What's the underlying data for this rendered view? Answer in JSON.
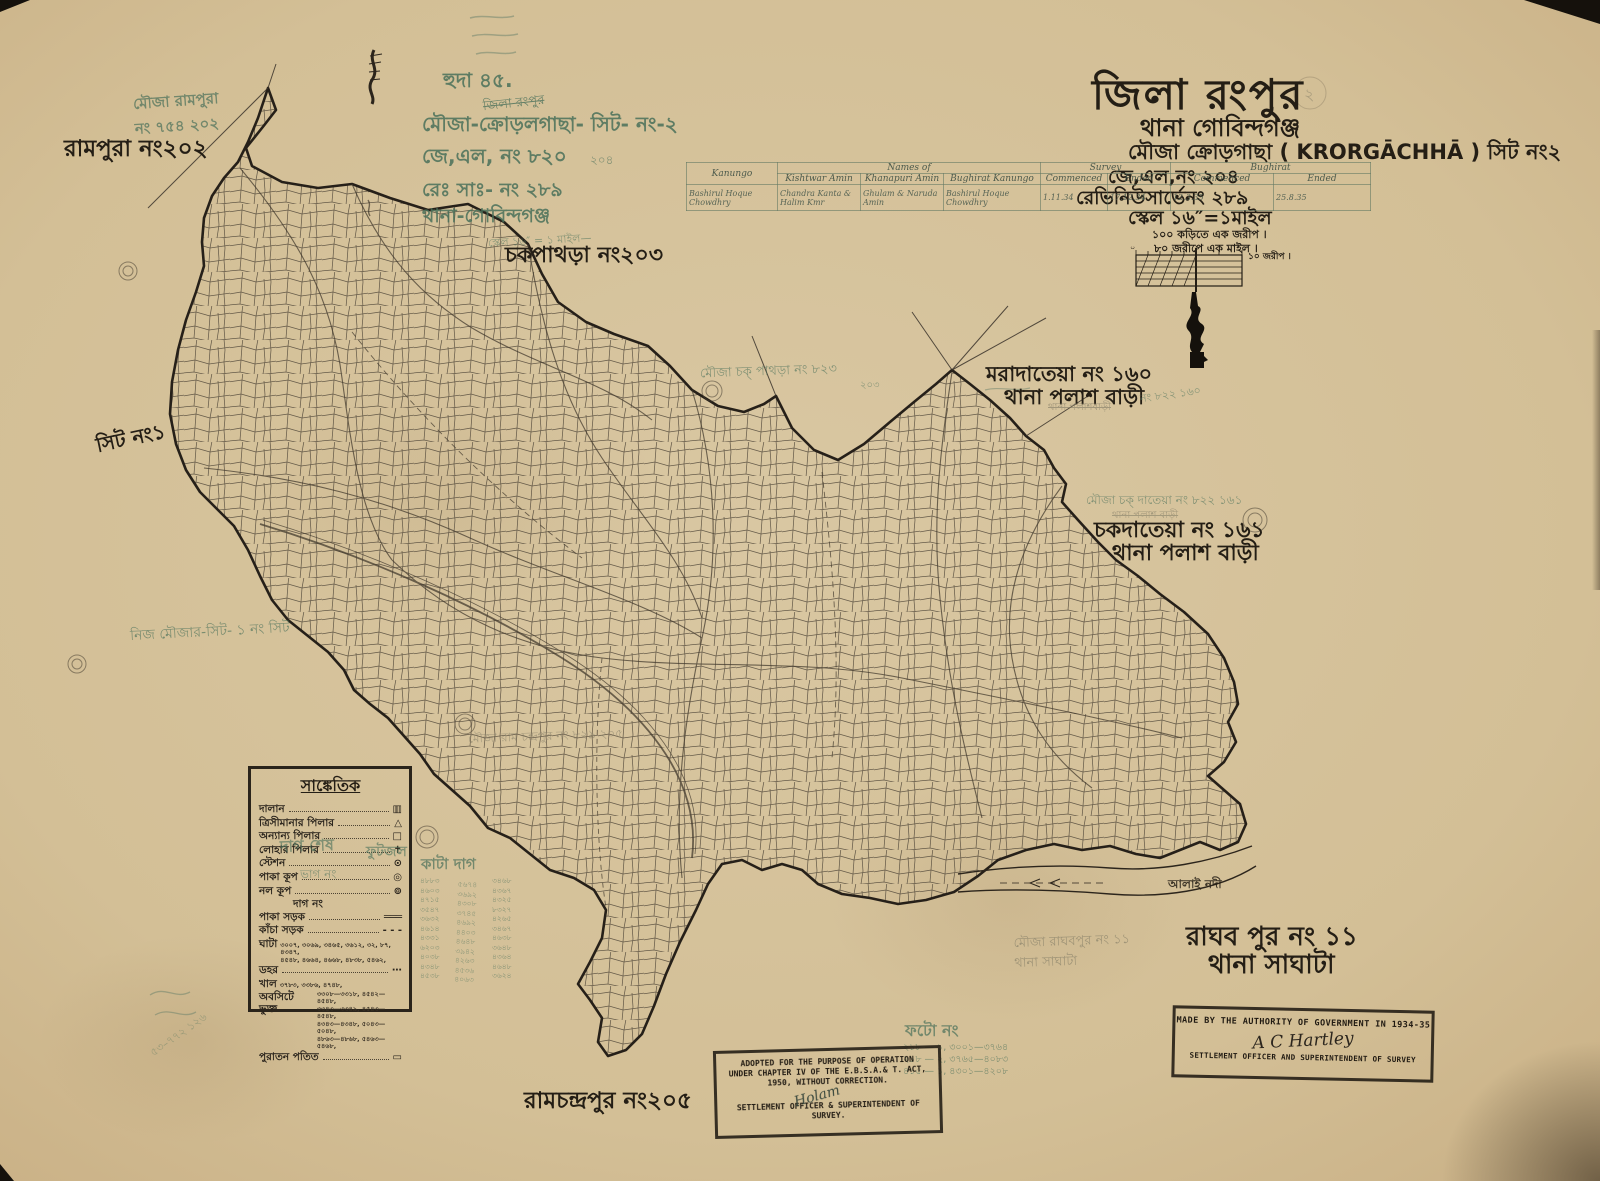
{
  "colors": {
    "paper": "#d3bf96",
    "ink": "#241e15",
    "green_ink": "#49705a",
    "pencil": "#7d7863",
    "table_line": "#6f8577"
  },
  "title_block": {
    "district": "জিলা রংপুর",
    "thana": "থানা গোবিন্দগঞ্জ",
    "mouza": "মৌজা ক্রোড়গাছা ( KRORGĀCHHĀ ) সিট নং২",
    "jl_no": "জে,এল,নং ২০৪",
    "revenue_survey_no": "রেভিনিউসার্ভেনং ২৮৯",
    "scale": "স্কেল ১৬″=১মাইল",
    "scale_note_1": "১০০ কড়িতে এক জরীপ ।",
    "scale_note_2": "৮০ জরীপে এক মাইল ।",
    "scale_bar_label": "১০ জরীপ ।",
    "scale_bar_zero": "০",
    "page_mark": "২"
  },
  "survey_table": {
    "col_kanungo": "Kanungo",
    "col_names_of": "Names of",
    "col_survey": "Survey",
    "col_right_block": "Bughirat",
    "sub_columns": [
      "Kishtwar Amin",
      "Khanapuri Amin",
      "Bughirat Kanungo",
      "Commenced",
      "Ended",
      "Commenced",
      "Ended"
    ],
    "entries": [
      "Bashirul Hoque Chowdhry",
      "Chandra Kanta & Halim Kmr",
      "Ghulam & Naruda Amin",
      "Bashirul Hoque Chowdhry",
      "1.11.34",
      "17.12.34",
      "12.3.35",
      "25.8.35"
    ]
  },
  "legend": {
    "title": "সাঙ্কেতিক",
    "rows": [
      {
        "label": "দালান",
        "symbol": "▥"
      },
      {
        "label": "ত্রিসীমানার পিলার",
        "symbol": "△"
      },
      {
        "label": "অন্যান্য পিলার",
        "symbol": "□"
      },
      {
        "label": "লোহার পিলার",
        "symbol": "✝"
      },
      {
        "label": "স্টেশন",
        "symbol": "⊙"
      },
      {
        "label": "পাকা কূপ",
        "symbol": "◎"
      },
      {
        "label": "নল কূপ",
        "symbol": "⊚"
      },
      {
        "label": "দাগ নং",
        "symbol": ""
      },
      {
        "label": "পাকা সড়ক",
        "symbol": "═══"
      },
      {
        "label": "কাঁচা সড়ক",
        "symbol": "‐ ‐ ‐"
      },
      {
        "label": "ঘাটা",
        "numbers": "৩০০৭, ৩০৬৯, ৩৪৬৫, ৩৬১২, ৩২, ৮৭, ৪৩৪৭,\n৪৫৪৮, ৪৬৬৪, ৪৬৬৮, ৪৮৩৮, ৫৪৬২,"
      },
      {
        "label": "ডহর",
        "symbol": "⋯"
      },
      {
        "label": "খাল",
        "numbers": "৩৭৮৩, ৩৩৮৬, ৪৭৪৮,"
      },
      {
        "label": "অবসিটে ভুক্ত",
        "numbers": "৩৩০৮—৩৩১৮, ৪৫৪২—৪৫৪৮,\n৩৩৪৩—৩৩৪৯, ৪৫৪৩—৪৫৪৮,\n৪৩৪৩—৪৩৪৮, ৫০৪৩—৫০৪৮,\n৪৮৬৩—৪৮৬৮, ৫৪৬৩—৫৪৬৮,"
      },
      {
        "label": "পুরাতন পতিত",
        "symbol": "▭"
      }
    ],
    "green_overwrite_1": "দাগ শেষ",
    "green_overwrite_2": "ফুটজল",
    "green_overwrite_3": "ভাগ নং"
  },
  "place_labels": {
    "rampura": "রামপুরা নং২০২",
    "sit_1": "সিট নং১",
    "chakpathra": "চকপাথড়া নং২০৩",
    "maradateya_1": "মরাদাতেয়া নং ১৬০",
    "maradateya_2": "থানা পলাশ বাড়ী",
    "chakdateya_1": "চকদাতেয়া নং ১৬১",
    "chakdateya_2": "থানা পলাশ বাড়ী",
    "raghabpur_1": "রাঘব পুর নং ১১",
    "raghabpur_2": "থানা সাঘাটা",
    "ramchandrapur": "রামচন্দ্রপুর নং২০৫",
    "alai_river": "আলাই নদী"
  },
  "annotations": {
    "rampura_pencil": "মৌজা রামপুরা\nনং ৭৫৪ ২০২",
    "huda": "হুদা ৪৫.",
    "jila_small": "জিলা রংপুর",
    "mouza_hand": "মৌজা-ক্রোড়লগাছা- সিট- নং-২",
    "jl_hand": "জে,এল, নং ৮২০",
    "jl_hand_small": "২০৪",
    "resa_hand": "রেঃ সাঃ- নং ২৮৯",
    "thana_hand": "থানা-গোবিন্দগঞ্জ",
    "scale_scrawl": "স্কেল ১৬″ = ১ মাইল—",
    "chak_pathra_pencil": "মৌজা চক্ পাথড়া নং ৮২৩",
    "chak_pathra_pencil_small": "২০৩",
    "maradateya_pencil": "নং ৮২২ ১৬০",
    "maradateya_pencil_struck": "থানা পলাশবাড়ী",
    "chak_dateya_pencil": "মৌজা চক্ দাতেয়া নং ৮২২ ১৬১",
    "chak_dateya_pencil_2": "থানা পলাশ বাড়ী",
    "nij_mouza": "নিজ মৌজার-সিট- ১ নং সিট",
    "ramchandrapur_pencil": "মৌজা রাম চন্দ্রপুর নং ৮২৯ ২০৫",
    "raghabpur_pencil": "মৌজা রাঘবপুর নং ১১\nথানা সাঘাটা",
    "kata_dag_heading": "কাটা দাগ",
    "kata_dag_col1": "৪৮৮৩\n৪৬০৩\n৪৭১৫\n৩৫৪৭\n৩৬৩২\n৪৬১৪\n৪৩৩১\n৬২০৩\n৪০৩৮\n৪৩৪৮\n৪৫৩৮",
    "kata_dag_col2": "৫৬৭৪\n৩৬৯২\n৪৩০৮\n৩৭৪৫\n৪৬৯২\n৪৪০৩\n৪৬৪৮\n৩৯৪২\n৪২৬৩\n৪৫৩৬\n৪০৬৩",
    "kata_dag_col3": "৩৪৬৮\n৪৩৬৭\n৪৩২৫\n৮৩২৭\n৪২৬৫\n৩৪৬৭\n৪৬৩৮\n৩৬৪৮\n৪৩৬৪\n৪৬৪৮\n৩৬২৪",
    "photo_heading": "ফটো নং",
    "photo_rows": "২১৮ — ১,   ৩০০১—৩৭৬৪\n২১৮ — ২,   ৩৭৬৫—৪০৮৩\n৪১৫ — ১,   ৪৩০১—৪২০৮",
    "corner_scribble": "৫৩–৭৭২ ১২৬",
    "circled_page_pencil": "২"
  },
  "stamps": {
    "adopted": {
      "line1": "ADOPTED FOR THE PURPOSE OF OPERATION",
      "line2": "UNDER CHAPTER IV OF THE E.B.S.A.& T. ACT,",
      "line3": "1950, WITHOUT CORRECTION.",
      "signature": "Holam",
      "line4": "SETTLEMENT OFFICER & SUPERINTENDENT OF",
      "line5": "SURVEY."
    },
    "authority": {
      "line1": "MADE BY THE AUTHORITY OF GOVERNMENT IN 1934-35",
      "signature": "A C Hartley",
      "line2": "SETTLEMENT OFFICER AND SUPERINTENDENT OF SURVEY"
    }
  }
}
